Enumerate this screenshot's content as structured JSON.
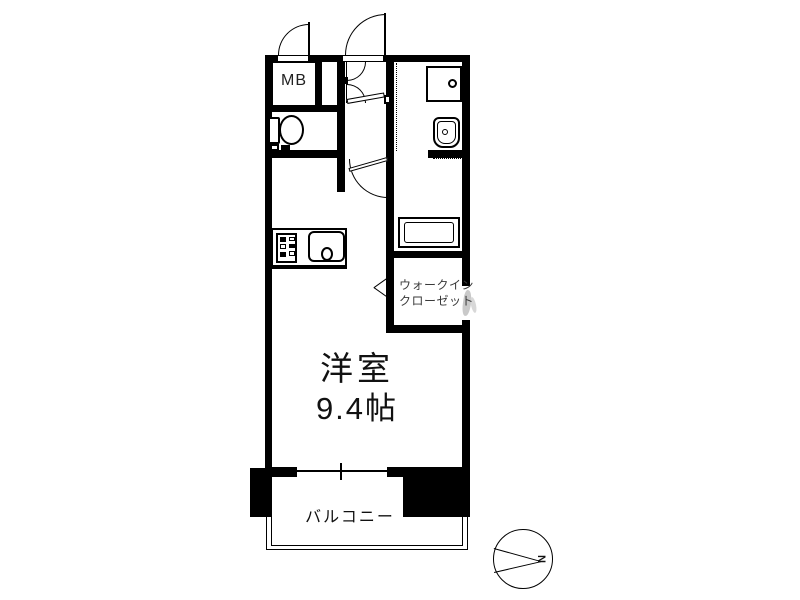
{
  "colors": {
    "wall": "#000000",
    "background": "#ffffff",
    "text": "#111111",
    "wic_text": "#3a3a3a",
    "watermark": "#c9c9c9"
  },
  "plan": {
    "meter_box_label": "MB",
    "main_room": {
      "name": "洋室",
      "area": "9.4帖"
    },
    "walk_in_closet": {
      "line1": "ウォークイン",
      "line2": "クローゼット"
    },
    "balcony_label": "バルコニー",
    "compass": {
      "north_label": "N"
    }
  }
}
